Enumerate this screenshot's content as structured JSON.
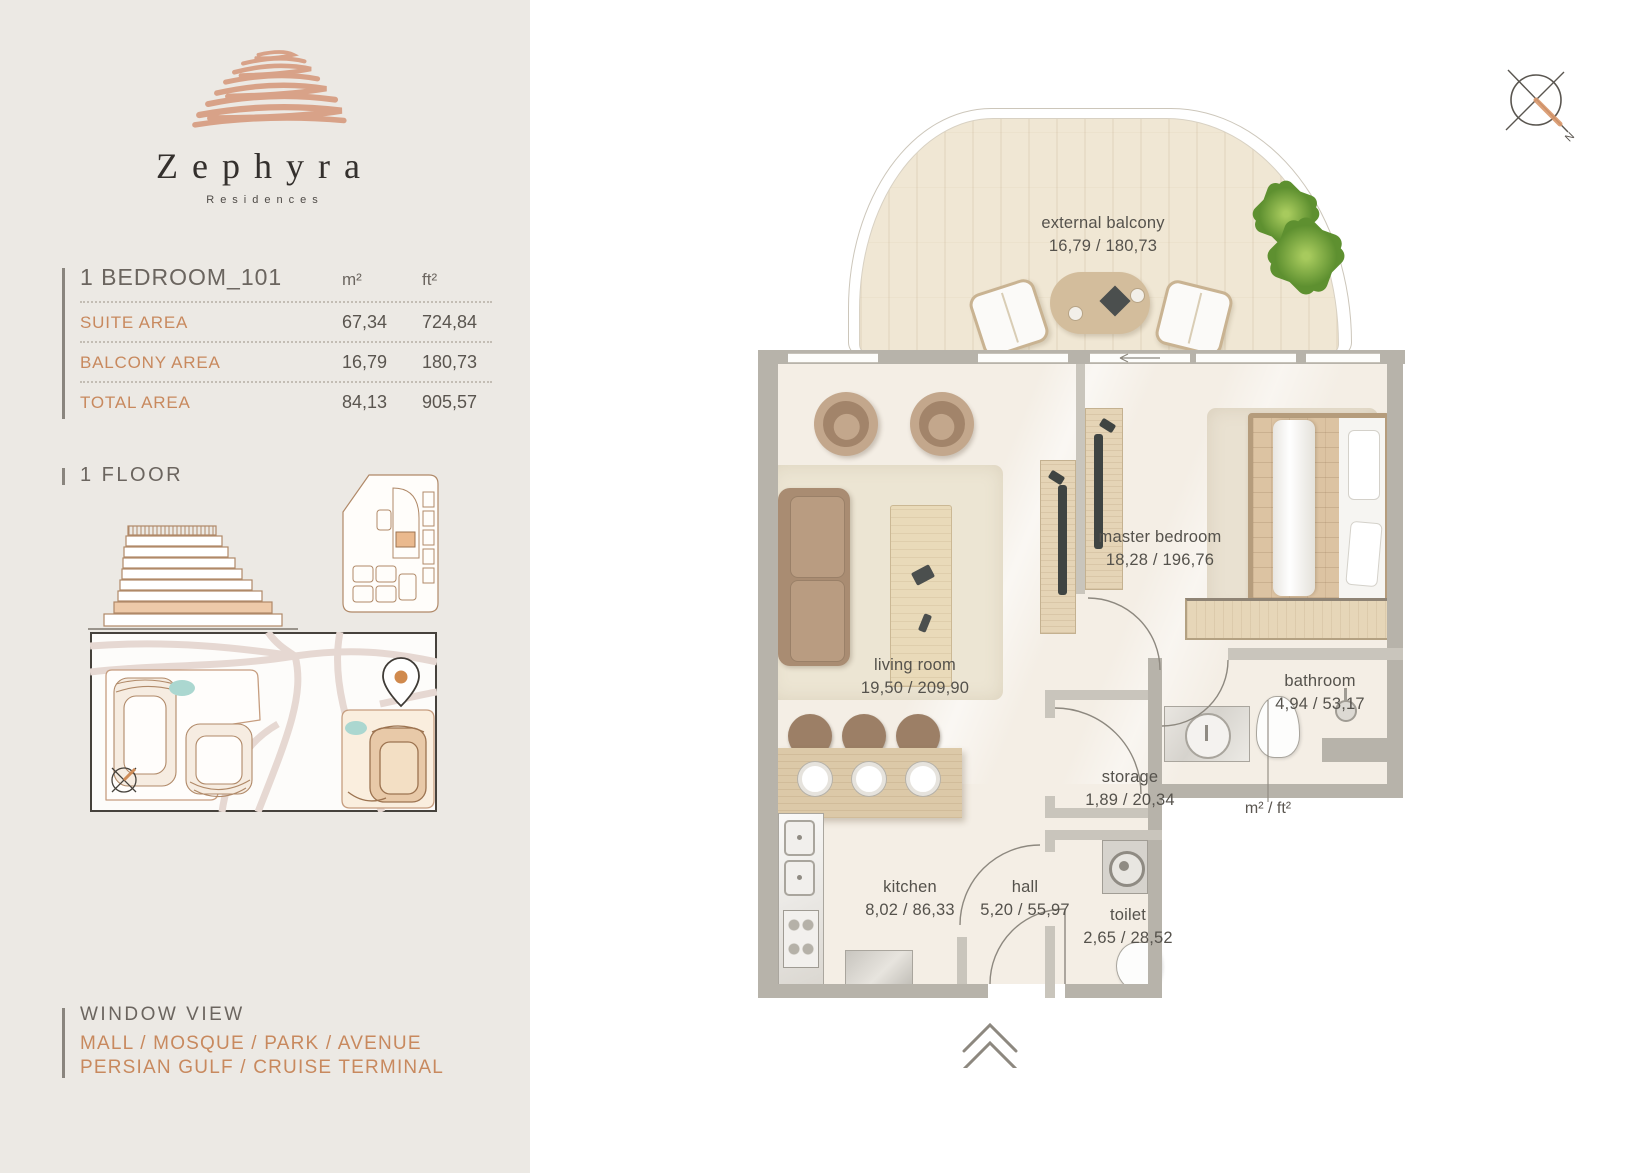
{
  "sidebar": {
    "brand": {
      "name": "Zephyra",
      "tagline": "Residences"
    },
    "unit_table": {
      "title": "1 BEDROOM_101",
      "col_m2": "m²",
      "col_ft2": "ft²",
      "rows": [
        {
          "label": "SUITE AREA",
          "m2": "67,34",
          "ft2": "724,84"
        },
        {
          "label": "BALCONY AREA",
          "m2": "16,79",
          "ft2": "180,73"
        },
        {
          "label": "TOTAL AREA",
          "m2": "84,13",
          "ft2": "905,57"
        }
      ]
    },
    "floor_label": "1 FLOOR",
    "window_view": {
      "title": "WINDOW VIEW",
      "line1": "MALL / MOSQUE / PARK / AVENUE",
      "line2": "PERSIAN GULF / CRUISE TERMINAL"
    }
  },
  "plan": {
    "rooms": [
      {
        "name": "external balcony",
        "area": "16,79 / 180,73"
      },
      {
        "name": "living room",
        "area": "19,50 / 209,90"
      },
      {
        "name": "master bedroom",
        "area": "18,28 / 196,76"
      },
      {
        "name": "bathroom",
        "area": "4,94 / 53,17"
      },
      {
        "name": "storage",
        "area": "1,89 / 20,34"
      },
      {
        "name": "kitchen",
        "area": "8,02 / 86,33"
      },
      {
        "name": "hall",
        "area": "5,20 / 55,97"
      },
      {
        "name": "toilet",
        "area": "2,65 / 28,52"
      }
    ],
    "legend": "m² / ft²",
    "compass": {
      "label": "N"
    }
  },
  "colors": {
    "accent": "#c8895e",
    "wall": "#b7b3aa",
    "floor": "#f4eee5",
    "sidebar_bg": "#ece9e4"
  }
}
